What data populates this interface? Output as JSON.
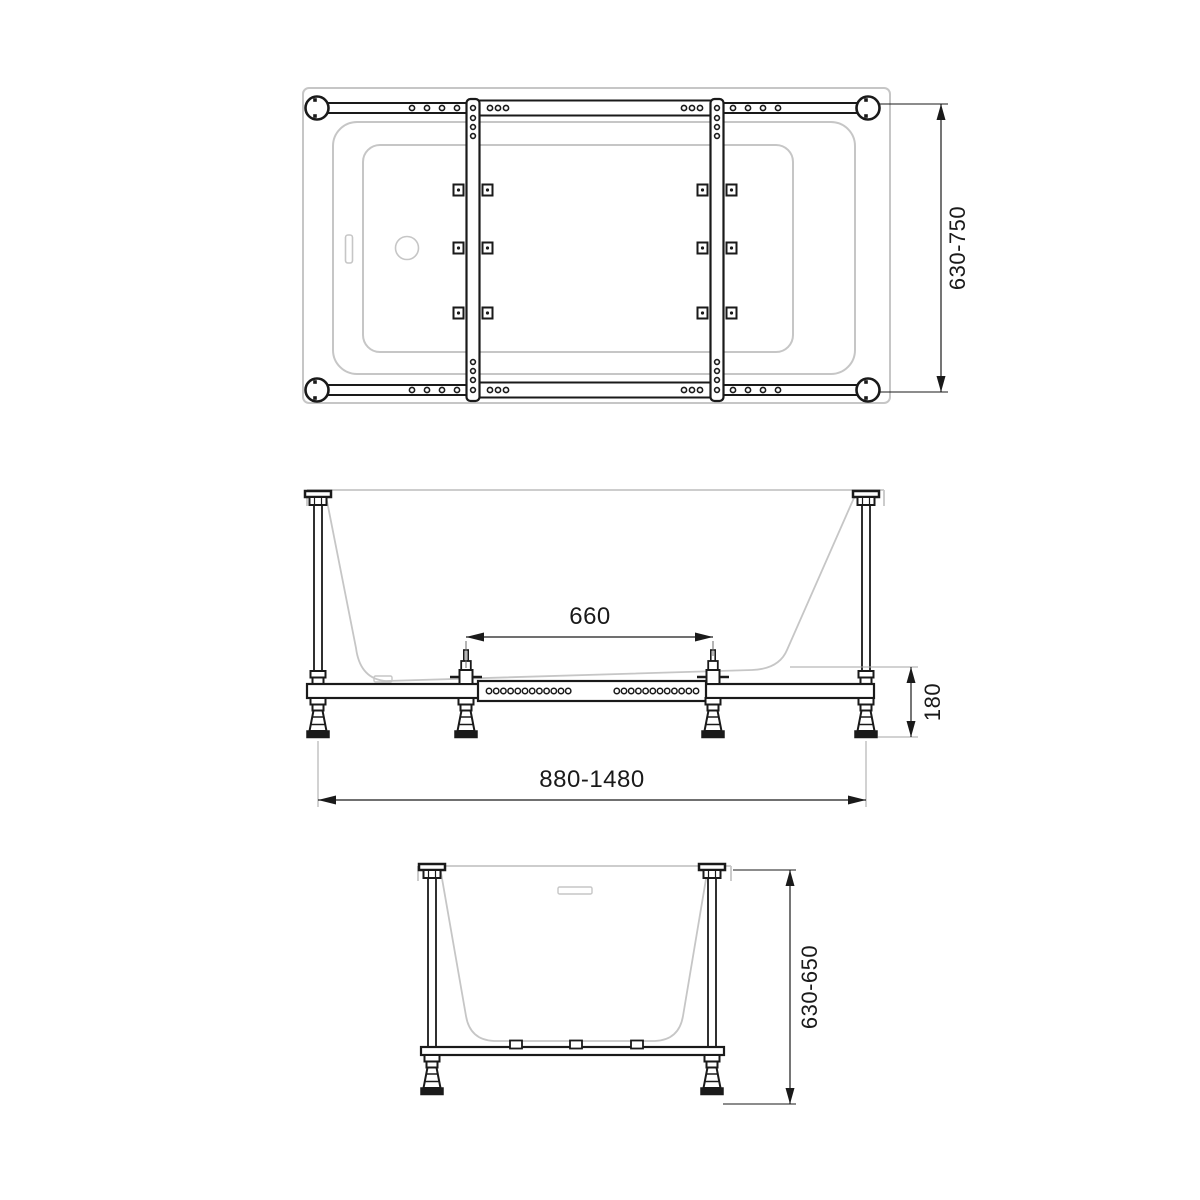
{
  "views": {
    "top_view": {
      "label": "top-plan-view",
      "dimensions": {
        "depth_range": "630-750"
      }
    },
    "front_view": {
      "label": "front-elevation-view",
      "dimensions": {
        "center_bracket_span": "660",
        "frame_height": "180",
        "length_range": "880-1480"
      }
    },
    "side_view": {
      "label": "side-elevation-view",
      "dimensions": {
        "height_range": "630-650"
      }
    }
  },
  "colors": {
    "frame_line": "#1a1a1a",
    "tub_outline": "#c6c6c6",
    "dimension_line": "#1a1a1a",
    "extension_line_gray": "#a6a6a6",
    "background": "#ffffff"
  }
}
